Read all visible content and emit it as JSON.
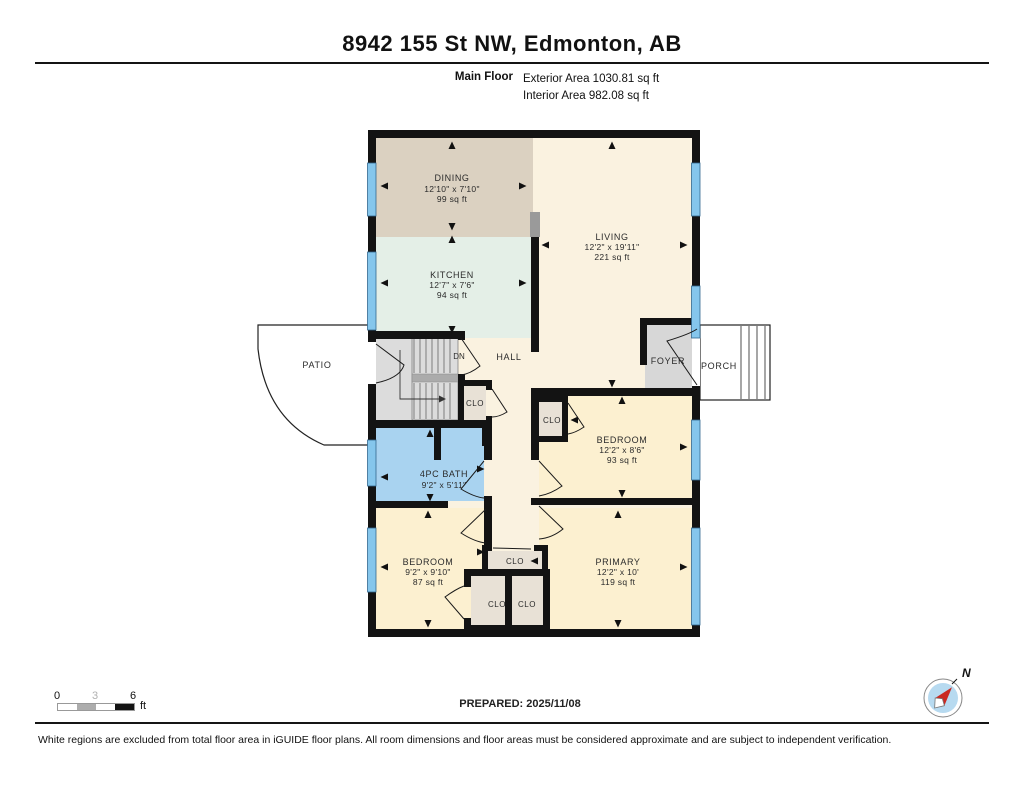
{
  "header": {
    "title": "8942 155 St NW, Edmonton, AB",
    "floor_label": "Main Floor",
    "exterior_area": "Exterior Area 1030.81 sq ft",
    "interior_area": "Interior Area 982.08 sq ft"
  },
  "rooms": {
    "dining": {
      "name": "DINING",
      "dims": "12'10\" x 7'10\"",
      "area": "99 sq ft"
    },
    "kitchen": {
      "name": "KITCHEN",
      "dims": "12'7\" x 7'6\"",
      "area": "94 sq ft"
    },
    "living": {
      "name": "LIVING",
      "dims": "12'2\" x 19'11\"",
      "area": "221 sq ft"
    },
    "bath": {
      "name": "4PC BATH",
      "dims": "9'2\" x 5'11\""
    },
    "bedroom2": {
      "name": "BEDROOM",
      "dims": "12'2\" x 8'6\"",
      "area": "93 sq ft"
    },
    "bedroom3": {
      "name": "BEDROOM",
      "dims": "9'2\" x 9'10\"",
      "area": "87 sq ft"
    },
    "primary": {
      "name": "PRIMARY",
      "dims": "12'2\" x 10'",
      "area": "119 sq ft"
    }
  },
  "areas": {
    "hall": "HALL",
    "foyer": "FOYER",
    "porch": "PORCH",
    "patio": "PATIO",
    "closet": "CLO",
    "stairs_down": "DN"
  },
  "footer": {
    "scale_0": "0",
    "scale_3": "3",
    "scale_6": "6",
    "scale_unit": "ft",
    "prepared": "PREPARED: 2025/11/08",
    "compass_north": "N",
    "disclaimer": "White regions are excluded from total floor area in iGUIDE floor plans. All room dimensions and floor areas must be considered approximate and are subject to independent verification."
  },
  "colors": {
    "wall": "#131313",
    "window": "#85c6ec",
    "dining_floor": "#dbd1c1",
    "kitchen_floor": "#e4efe7",
    "living_floor": "#faf2e0",
    "bedroom_floor": "#fcf0d0",
    "bath_floor": "#a9d3f0",
    "closet_floor": "#e8e1d6",
    "stairs_floor": "#dcdcdc",
    "compass_red": "#c92a23"
  }
}
